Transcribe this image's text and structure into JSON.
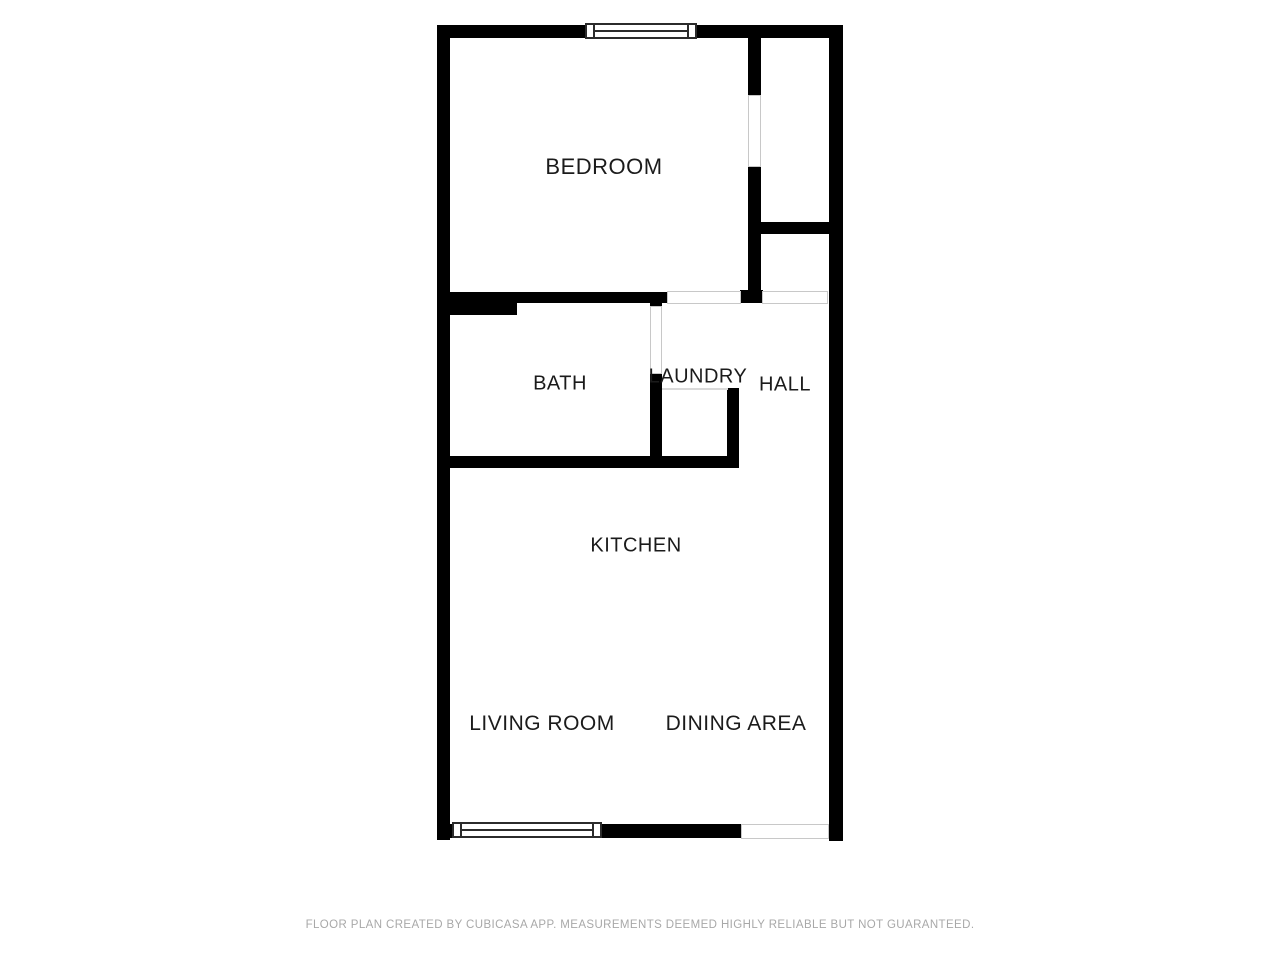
{
  "canvas": {
    "background": "#ffffff"
  },
  "floor_plan": {
    "wall_color": "#000000",
    "window_frame_color": "#2b2b2b",
    "opening_outline_color": "#c8c8c8",
    "label_color": "#1b1b1b",
    "rooms": {
      "bedroom": {
        "label": "BEDROOM"
      },
      "bath": {
        "label": "BATH"
      },
      "laundry": {
        "label": "LAUNDRY"
      },
      "hall": {
        "label": "HALL"
      },
      "kitchen": {
        "label": "KITCHEN"
      },
      "living_room": {
        "label": "LIVING ROOM"
      },
      "dining_area": {
        "label": "DINING AREA"
      }
    },
    "symbols": {
      "windows": [
        "window-top",
        "window-bottom"
      ],
      "door_openings": [
        "bedroom-closet-door",
        "bedroom-hall-opening",
        "closet-nook-opening",
        "bath-door",
        "laundry-opening",
        "entry-opening"
      ]
    }
  },
  "footer": {
    "text": "FLOOR PLAN CREATED BY CUBICASA APP. MEASUREMENTS DEEMED HIGHLY RELIABLE BUT NOT GUARANTEED."
  }
}
